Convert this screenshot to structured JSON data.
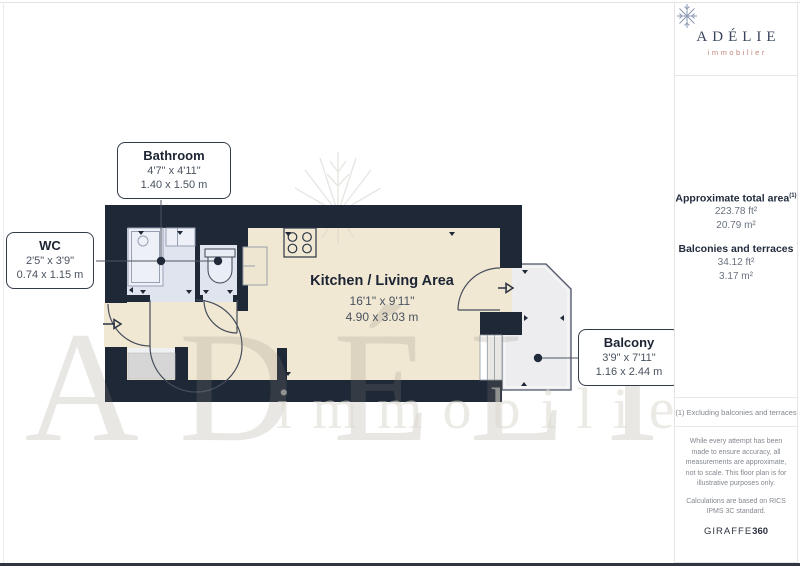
{
  "plan": {
    "rooms": {
      "bathroom": {
        "name": "Bathroom",
        "imperial": "4'7\" x 4'11\"",
        "metric": "1.40 x 1.50 m"
      },
      "wc": {
        "name": "WC",
        "imperial": "2'5\" x 3'9\"",
        "metric": "0.74 x 1.15 m"
      },
      "kitchen": {
        "name": "Kitchen / Living Area",
        "imperial": "16'1\" x 9'11\"",
        "metric": "4.90 x 3.03 m"
      },
      "balcony": {
        "name": "Balcony",
        "imperial": "3'9\" x 7'11\"",
        "metric": "1.16 x 2.44 m"
      }
    },
    "watermark": {
      "brand": "ADÉLIE",
      "tagline": "immobilier"
    }
  },
  "sidebar": {
    "logo": {
      "brand": "ADÉLIE",
      "tagline": "immobilier"
    },
    "areas": {
      "total_label": "Approximate total area",
      "total_note_ref": "(1)",
      "total_ft": "223.78 ft²",
      "total_m": "20.79 m²",
      "balconies_label": "Balconies and terraces",
      "balconies_ft": "34.12 ft²",
      "balconies_m": "3.17 m²"
    },
    "footnote": "(1) Excluding balconies and terraces",
    "disclaimer": "While every attempt has been made to ensure accuracy, all measurements are approximate, not to scale. This floor plan is for illustrative purposes only.",
    "standard": "Calculations are based on RICS IPMS 3C standard.",
    "credit": {
      "brand": "GIRAFFE",
      "suffix": "360"
    }
  },
  "colors": {
    "wall": "#1e2836",
    "floor": "#f1e8d3",
    "wet": "#dfe4ef",
    "balcony": "#ededef",
    "title": "#1c2433",
    "dims": "#49525f"
  }
}
